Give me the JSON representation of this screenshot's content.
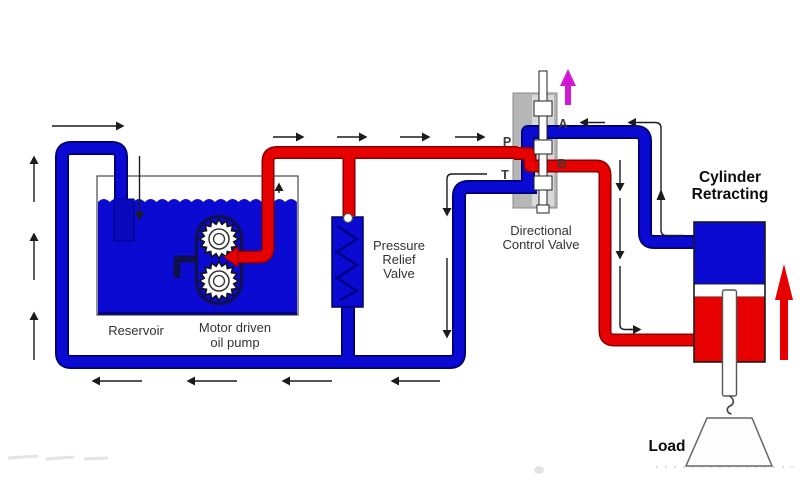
{
  "diagram": {
    "type": "hydraulic-circuit-schematic",
    "state": {
      "cylinder_label_line1": "Cylinder",
      "cylinder_label_line2": "Retracting"
    },
    "components": {
      "reservoir_label": "Reservoir",
      "pump_label_line1": "Motor driven",
      "pump_label_line2": "oil pump",
      "relief_label_line1": "Pressure",
      "relief_label_line2": "Relief",
      "relief_label_line3": "Valve",
      "dcv_label_line1": "Directional",
      "dcv_label_line2": "Control Valve",
      "load_label": "Load"
    },
    "ports": {
      "p": "P",
      "a": "A",
      "b": "B",
      "t": "T"
    },
    "colors": {
      "pressure_line_red": "#e60000",
      "return_line_blue": "#0a0ad2",
      "pipe_outline": "#000070",
      "valve_body_gray": "#b6b6b6",
      "valve_bore_gray": "#d9d9d9",
      "spool_actuator_magenta": "#d119d1",
      "flow_arrow_black": "#1c1c1c"
    }
  }
}
